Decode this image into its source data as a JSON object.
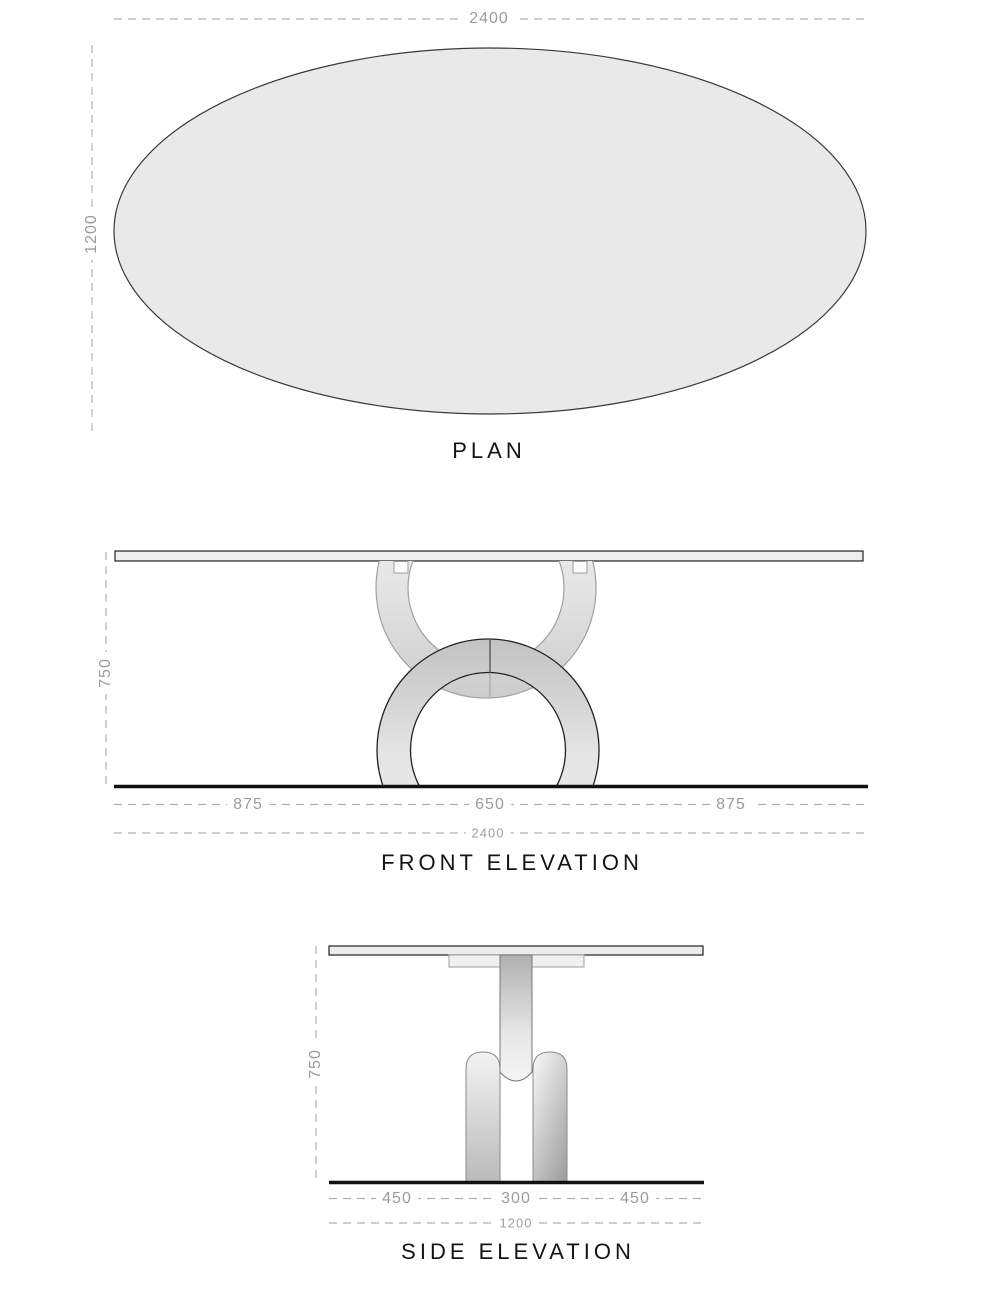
{
  "sheet": {
    "background": "#ffffff",
    "type_of_drawing": "furniture orthographic views"
  },
  "views": {
    "plan": {
      "title": "PLAN",
      "dimensions": {
        "total_width": "2400",
        "total_depth": "1200"
      }
    },
    "front_elevation": {
      "title": "FRONT ELEVATION",
      "dimensions": {
        "height": "750",
        "left_overhang": "875",
        "base_width": "650",
        "right_overhang": "875",
        "total_width": "2400"
      }
    },
    "side_elevation": {
      "title": "SIDE ELEVATION",
      "dimensions": {
        "height": "750",
        "left_overhang": "450",
        "base_width": "300",
        "right_overhang": "450",
        "total_width": "1200"
      }
    }
  },
  "colors": {
    "outline_black": "#1a1a1a",
    "hidden_line_gray": "#a0a0a0",
    "dimension_gray": "#9b9b9b",
    "dash_gray": "#b0b0b0",
    "surface_fill": "#e9e9e9",
    "metal_dark": "#b0b0b0",
    "metal_light": "#f4f4f4"
  }
}
